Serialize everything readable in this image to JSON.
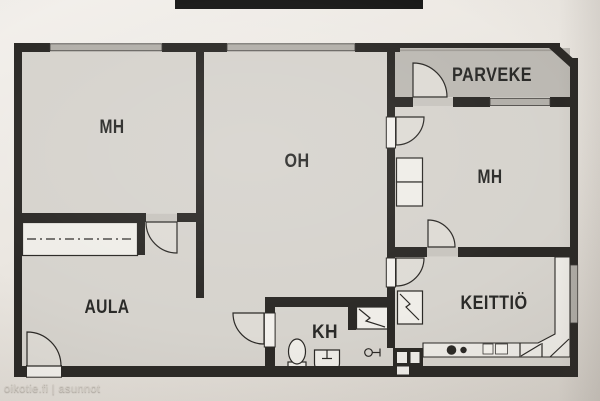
{
  "rooms": {
    "bedroom_left": {
      "label": "MH"
    },
    "living_room": {
      "label": "OH"
    },
    "balcony": {
      "label": "PARVEKE"
    },
    "bedroom_right": {
      "label": "MH"
    },
    "hall": {
      "label": "AULA"
    },
    "bathroom": {
      "label": "KH"
    },
    "kitchen": {
      "label": "KEITTIÖ"
    }
  },
  "watermark": {
    "text": "oikotie.fi | asunnot"
  },
  "colors": {
    "wall": "#2b2926",
    "floor": "#d6d3cd",
    "balcony_floor": "#bcb9b3",
    "window": "#b2afa9",
    "threshold": "#c8c5bf",
    "fixture_fill": "#efede8",
    "label": "#2a2a28",
    "paper_light": "#f3f0ec",
    "paper_dark": "#d8d3cc",
    "watermark_text": "#d8d3cb"
  },
  "fixtures": [
    "door-swing-icon",
    "window",
    "balcony-threshold",
    "hall-closet",
    "wardrobe",
    "shower-icon",
    "toilet-icon",
    "washbasin-icon",
    "faucet-icon",
    "duct-shaft",
    "kitchen-counter",
    "stove-icon",
    "sink-unit-icon",
    "dishwasher-icon",
    "cabinet"
  ]
}
